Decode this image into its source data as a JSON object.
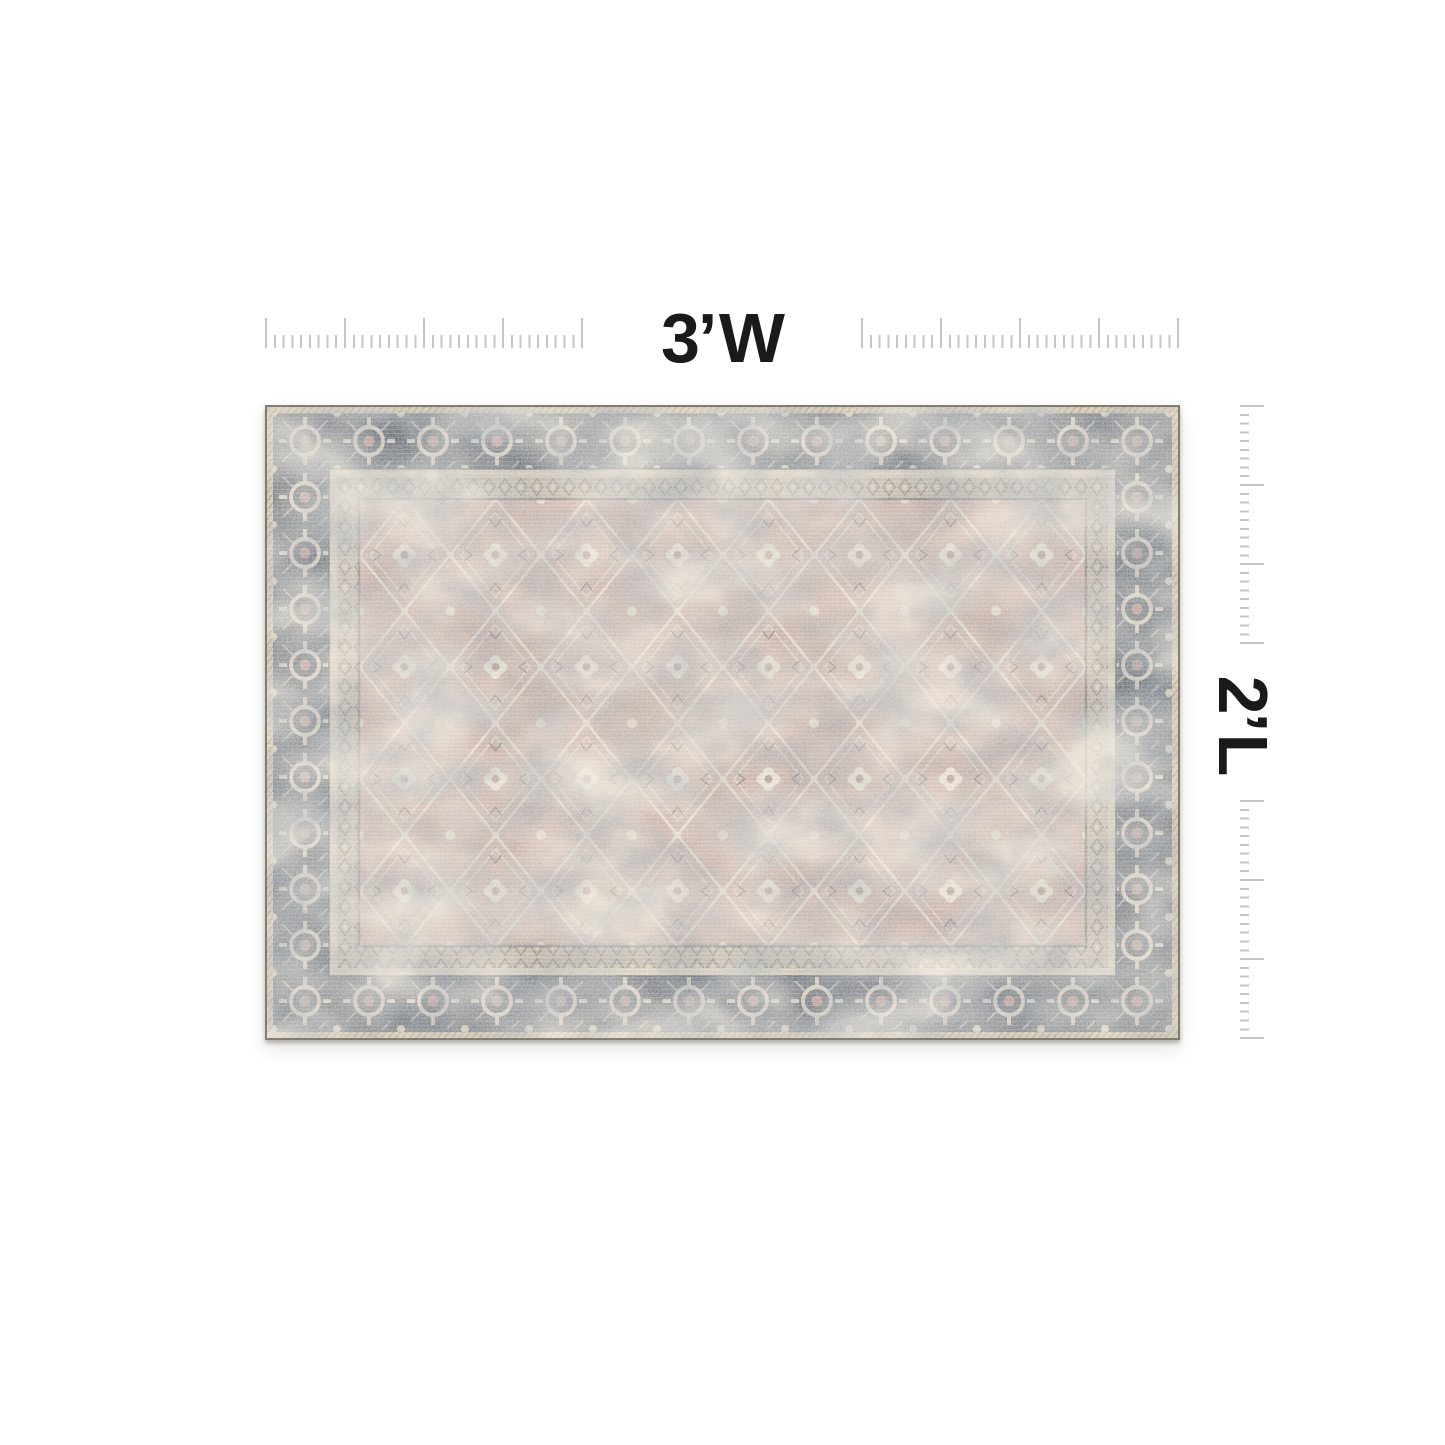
{
  "page": {
    "background_color": "#ffffff"
  },
  "dimensions": {
    "width_label": "3’ W",
    "length_label": "2’ L"
  },
  "rulers": {
    "tick_color": "#c6c6c6",
    "top_ruler": "horizontal, split left and right of width label",
    "right_ruler": "vertical, split above and below length label"
  },
  "rug": {
    "description": "distressed vintage oriental area rug, blush-taupe field with charcoal ornate border and tan serged edge",
    "colors": {
      "selvage": "#cdbd9e",
      "border": "#59616c",
      "guard": "#d2c8b6",
      "minor_border": "#bfb3a5",
      "field": "#c6aaa1",
      "pattern_ivory": "#e3dacb",
      "accent_rose": "#b08a80",
      "accent_slate": "#5a646e"
    }
  }
}
